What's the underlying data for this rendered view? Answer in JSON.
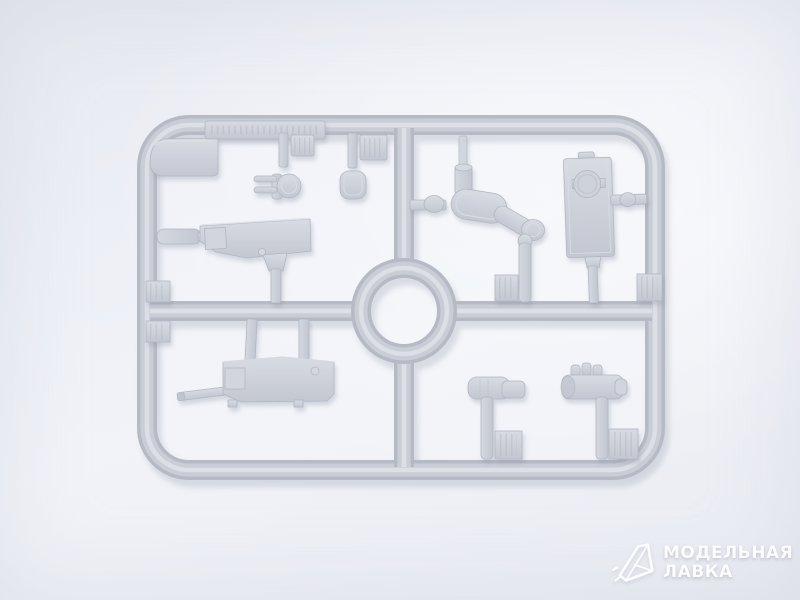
{
  "photo": {
    "subject": "Light gray injection-molded plastic model kit sprue photographed on a pale background",
    "sprue": {
      "frame_shape": "rounded rectangle with central cross runners and a center ring",
      "parts_visible": [
        "corner wedge plate",
        "embossed label plate on top runner",
        "fork-shaped part with round head",
        "rounded-square head part",
        "gun cradle box with side cylinder",
        "periscope arm assembly",
        "rectangular hatch plate with round detail",
        "machine gun with barrel",
        "stepped cylinder part",
        "knobbed breech part",
        "ribbed sprue tabs",
        "center ring runner"
      ]
    }
  },
  "watermark": {
    "line1": "МОДЕЛЬНАЯ",
    "line2": "ЛАВКА",
    "logo_icon": "crystal-gem"
  },
  "colors": {
    "background": "#edeff6",
    "plastic_base": "#cacdd6",
    "plastic_edge": "#b6bac5",
    "plastic_highlight": "#dcdfe5",
    "cast_shadow": "#8d93a2",
    "watermark_text": "#ffffff"
  }
}
